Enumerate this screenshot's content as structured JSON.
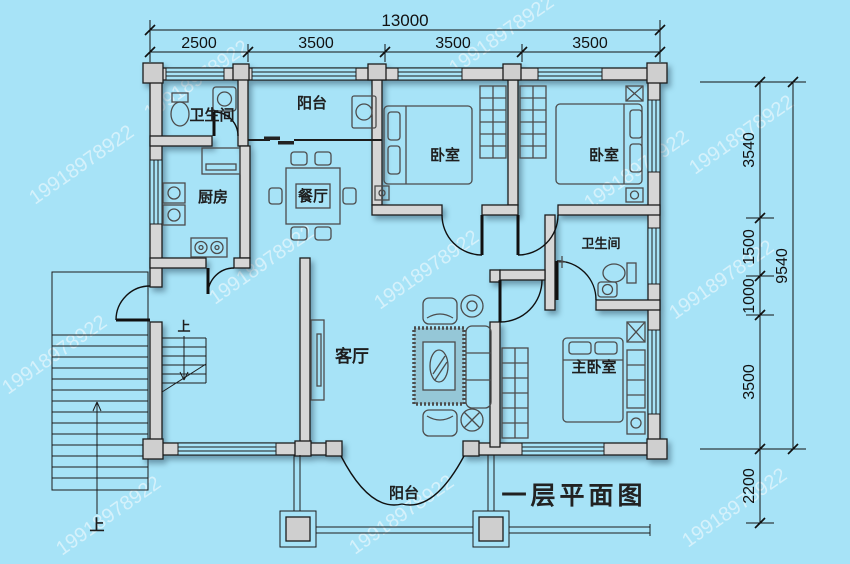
{
  "title": "一层平面图",
  "watermark": {
    "text": "19918978922",
    "color": "#ffffff"
  },
  "palette": {
    "background": "#a7e3f7",
    "wall_fill": "#d6d6d6",
    "outline": "#1c1c1c",
    "furniture": "#4c4c4c",
    "text": "#111111"
  },
  "dimensions": {
    "top": {
      "total": "13000",
      "segments": [
        "2500",
        "3500",
        "3500",
        "3500"
      ]
    },
    "right": {
      "total": "9540",
      "segments": [
        "3540",
        "1500",
        "1000",
        "3500",
        "2200"
      ]
    }
  },
  "rooms": {
    "bathroom_top_left": "卫生间",
    "balcony_top": "阳台",
    "kitchen": "厨房",
    "dining": "餐厅",
    "bedroom_left": "卧室",
    "bedroom_right": "卧室",
    "bathroom_right": "卫生间",
    "living": "客厅",
    "master_bedroom": "主卧室",
    "balcony_bottom": "阳台"
  },
  "stairs": {
    "up_exterior": "上",
    "up_interior": "上"
  }
}
